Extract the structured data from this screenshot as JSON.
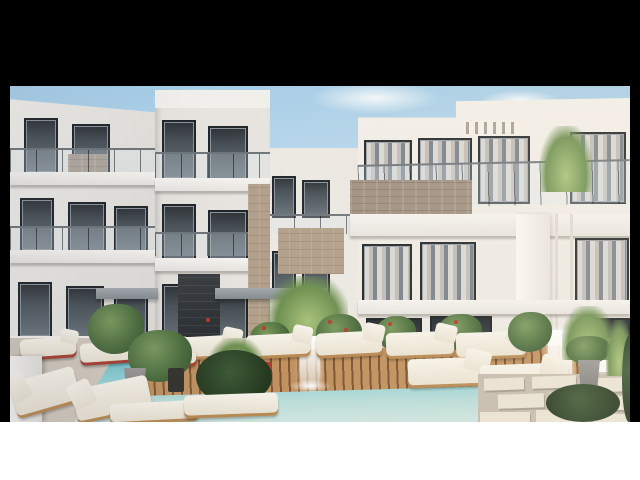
{
  "meta": {
    "type": "architectural-exterior-render",
    "description": "3D rendering of a modern white residential apartment complex with balconies, a turquoise swimming pool, wooden sun deck, loungers and tropical landscaping"
  },
  "frame": {
    "top_bar_color": "#000000",
    "side_bar_color": "#000000",
    "bottom_bar_color": "#ffffff"
  },
  "palette": {
    "sky_top": "#a6cde7",
    "sky_horizon": "#e3eef5",
    "facade_light": "#f2efe9",
    "facade_shaded": "#dedbd6",
    "window_glass_dark": "#3a4248",
    "curtain_light": "#dad7d3",
    "slate_stone_dark": "#303437",
    "stone_tan": "#b2a08b",
    "stone_gray_brown": "#a09080",
    "canopy_gray": "#949a9e",
    "pool_deep": "#5fb6c2",
    "pool_shallow": "#cde4de",
    "wood_deck": "#c1925f",
    "cushion_cream": "#f2ede2",
    "red_accent": "#b0402f",
    "plant_green": "#5d7a4a",
    "paver_light": "#e9e2d4"
  },
  "scene": {
    "buildings": [
      {
        "name": "left-wing",
        "floors_visible": 3,
        "features": "glass balcony railings, dark framed windows"
      },
      {
        "name": "center-block",
        "floors_visible": 2,
        "features": "slate feature wall, tan stone column, gray walkway canopies"
      },
      {
        "name": "right-building",
        "floors_visible": 3,
        "features": "stone-clad balcony parapet, louver pergola, curtained windows, white pilaster"
      }
    ],
    "pool": {
      "water": "turquoise",
      "features": [
        "wooden slat sun deck jutting into pool",
        "two white cascade fountains"
      ]
    },
    "furniture": {
      "deck_loungers": 5,
      "red_rail_loungers": 3,
      "foreground_loungers": 2,
      "daybeds": 2,
      "white_chair": 1
    },
    "landscaping": [
      "balcony palm",
      "palms",
      "green shrubs",
      "red flowering plants",
      "potted plants",
      "dark hedges"
    ],
    "hardscape": [
      "stone pavers",
      "beige patio",
      "wood slat deck"
    ]
  }
}
